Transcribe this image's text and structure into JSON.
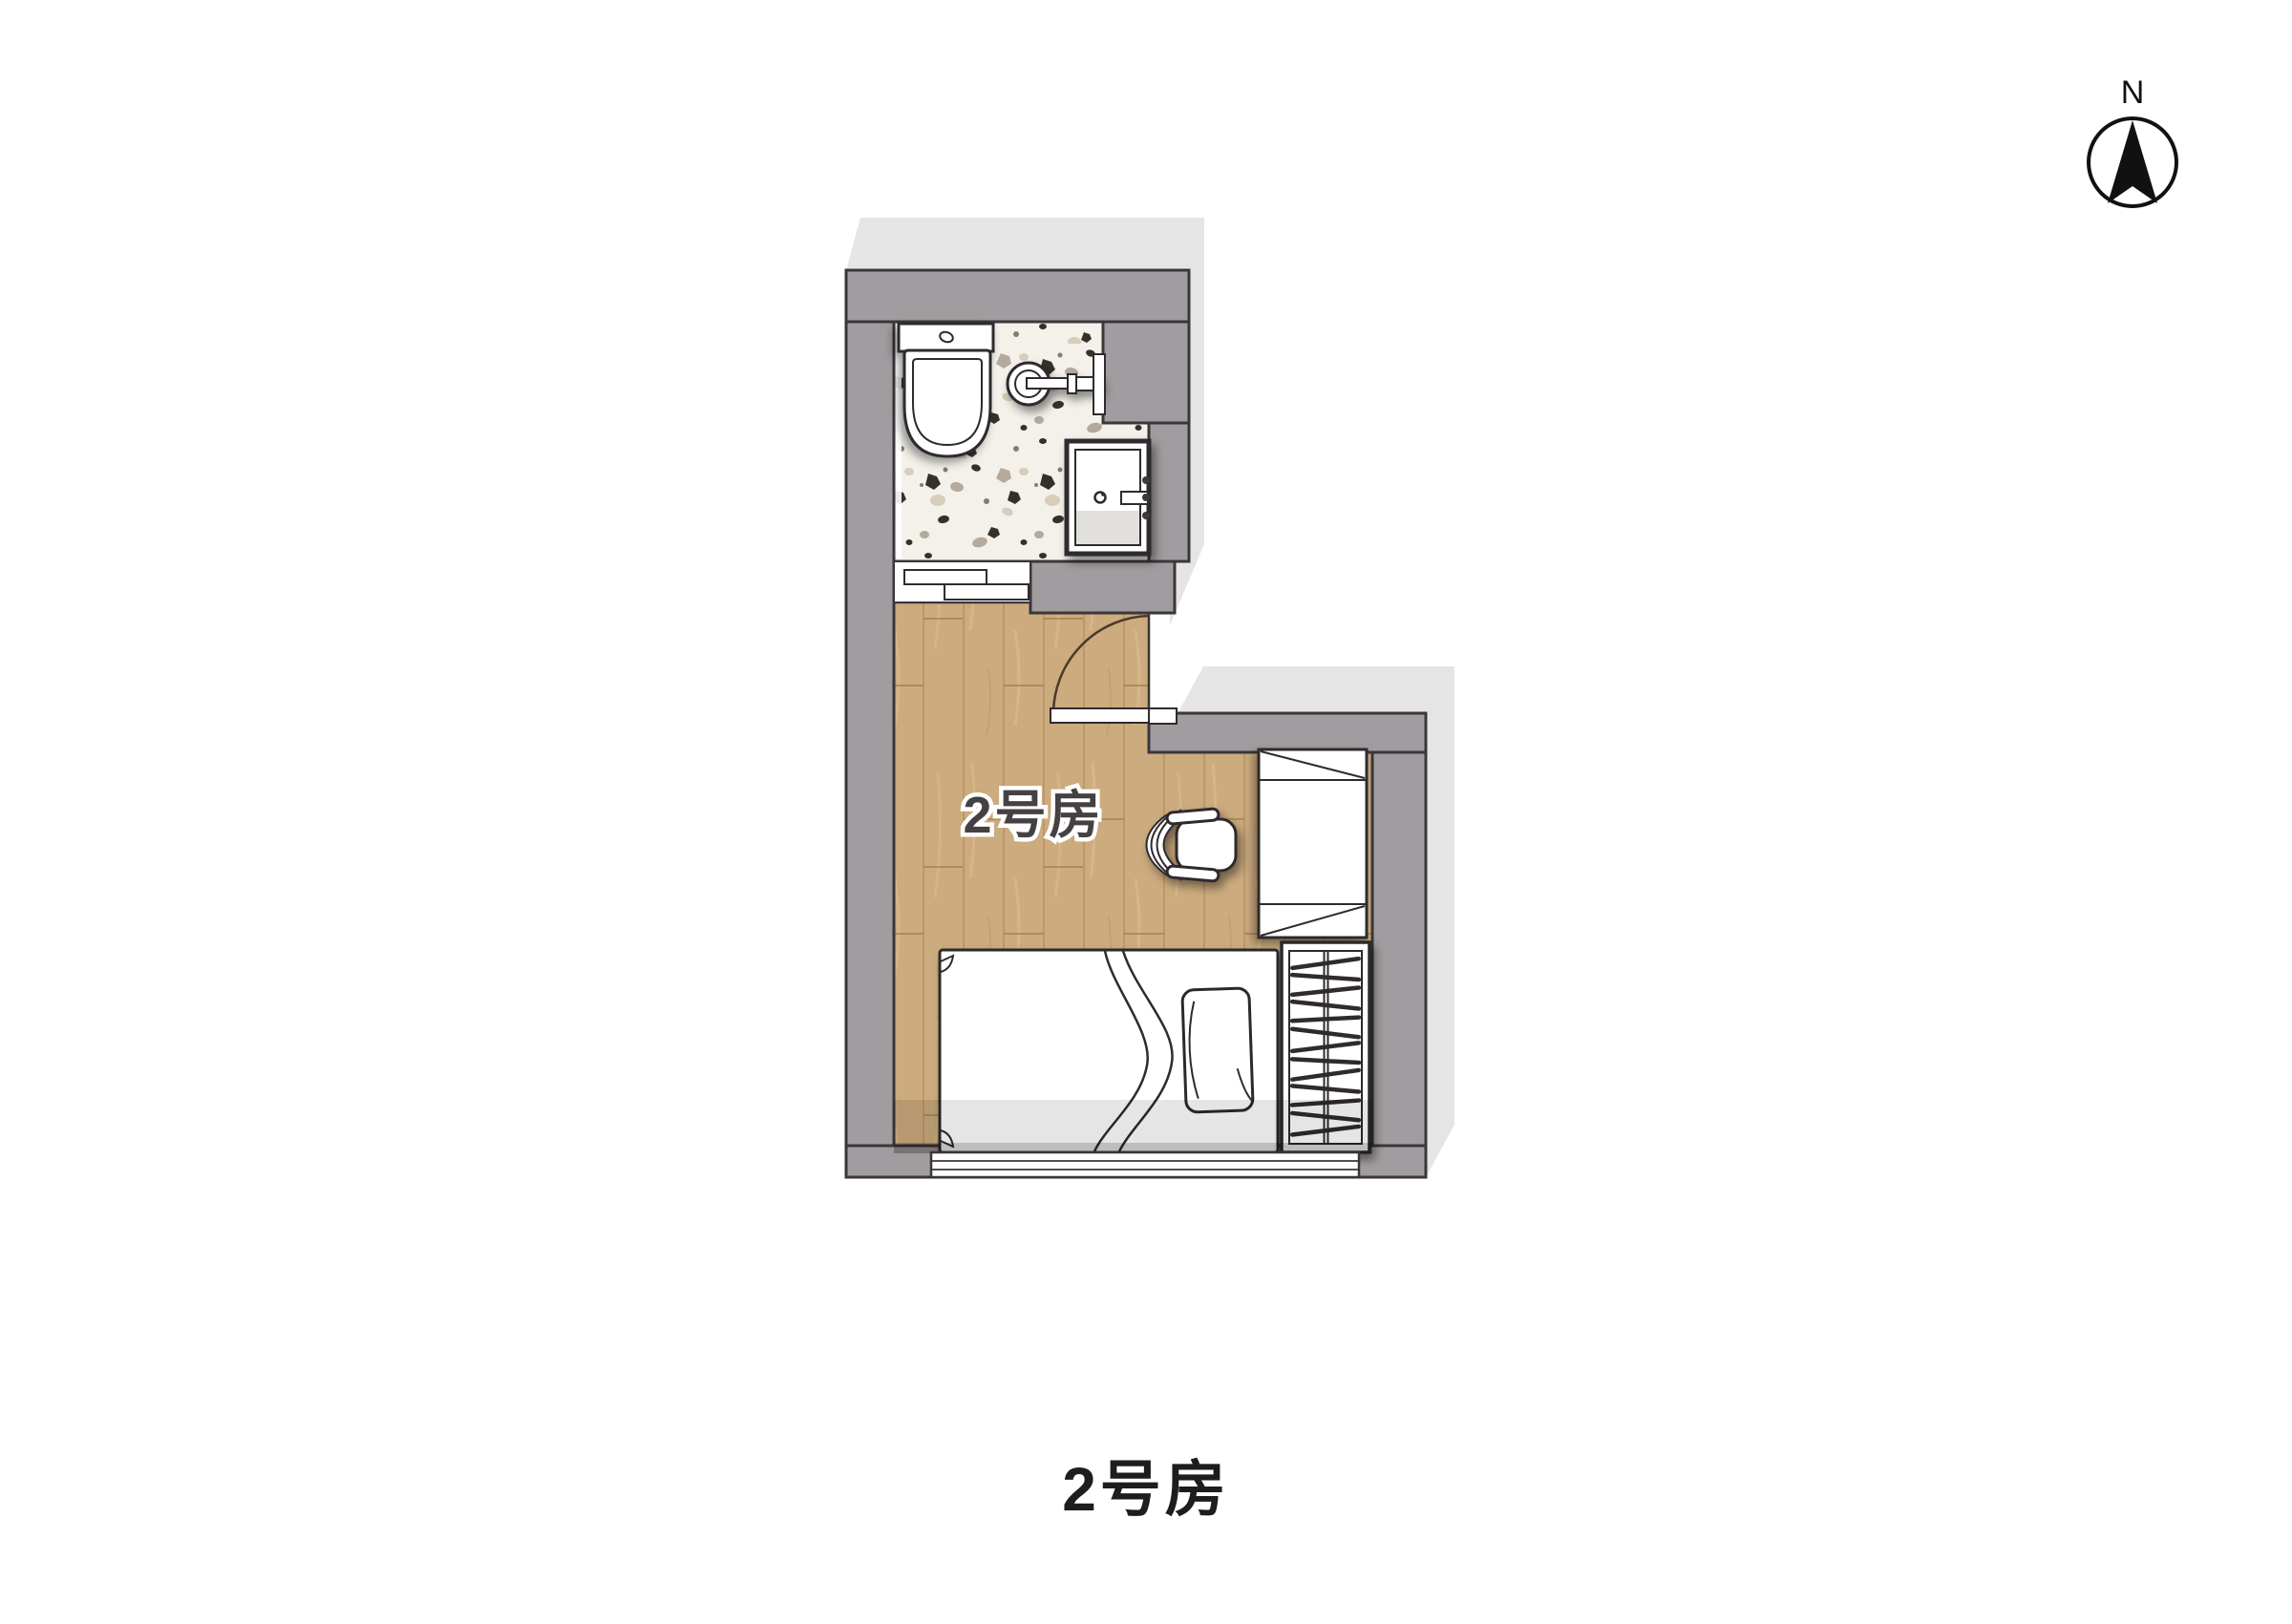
{
  "page": {
    "background": "#ffffff",
    "caption": "2号房"
  },
  "compass": {
    "label": "N"
  },
  "plan": {
    "room_label": "2号房",
    "colors": {
      "wall": "#a19c9f",
      "wall_outline": "#3a363a",
      "shadow": "#e6e5e6",
      "wood_floor": "#ccab7e",
      "wood_grain": "#b18c5c",
      "terrazzo_base": "#f4f1ea",
      "fixture_outline": "#2f2b2e",
      "glass": "#e2e0dd"
    },
    "elements": {
      "bathroom": [
        "toilet",
        "sink",
        "shower-unit",
        "sliding-door",
        "wall-niche"
      ],
      "bedroom": [
        "entry-door",
        "desk",
        "office-chair",
        "single-bed",
        "pillow",
        "wardrobe",
        "window"
      ]
    }
  }
}
